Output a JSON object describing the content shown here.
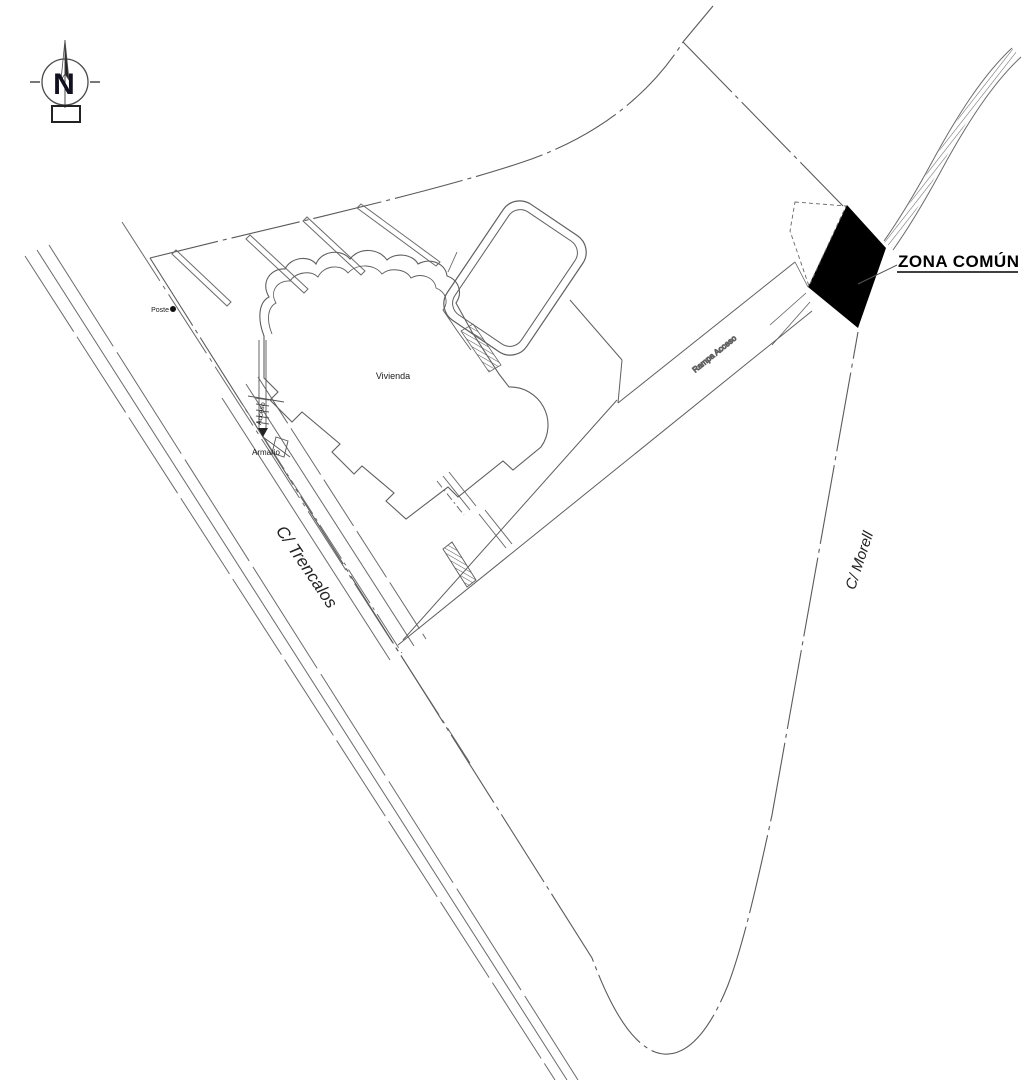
{
  "labels": {
    "north": "N",
    "zona_comun": "ZONA COMÚN",
    "vivienda": "Vivienda",
    "rampa_acceso": "Rampa Acceso",
    "armario": "Armario",
    "acceso": "Acceso",
    "poste": "Poste",
    "calle_trencalos": "C/ Trencalos",
    "calle_morell": "C/ Morell"
  },
  "icons": {
    "north_compass": "compass-rose-north",
    "poste_marker": "filled-dot",
    "access_arrow": "down-arrow"
  },
  "colors": {
    "line": "#6b6b6b",
    "boundary": "#5a5a5a",
    "dark_text": "#1a1a1a",
    "zona_comun_fill": "#000000",
    "background": "#ffffff"
  }
}
